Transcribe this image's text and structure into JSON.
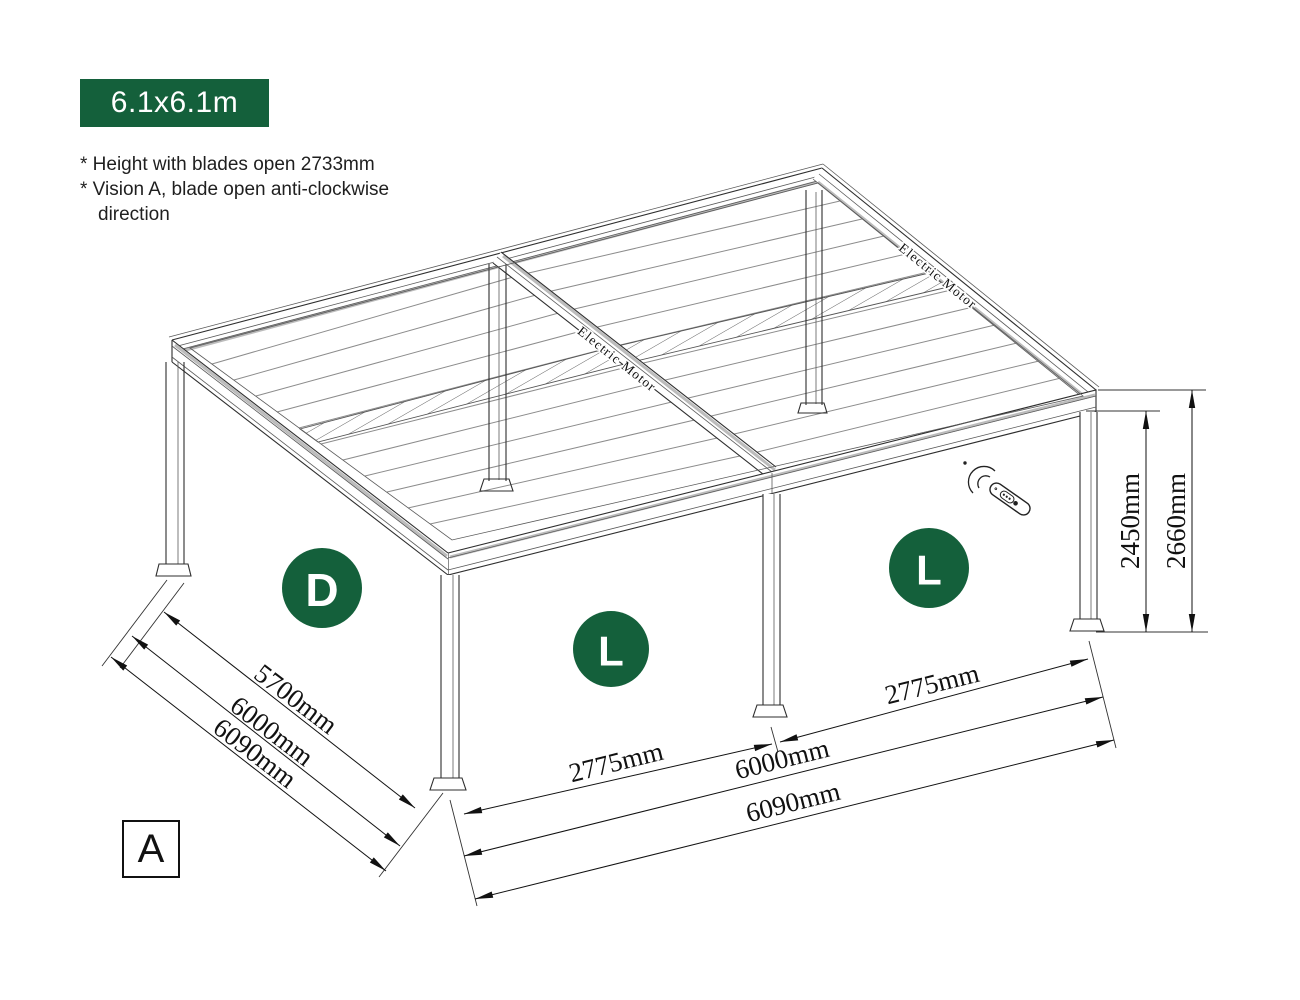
{
  "theme": {
    "accent_green": "#14603B",
    "line_color": "#2e2e2e",
    "background": "#ffffff"
  },
  "header": {
    "size_badge": {
      "label": "6.1x6.1m"
    },
    "notes": [
      "* Height with blades open 2733mm",
      "* Vision A, blade open anti-clockwise",
      "direction"
    ]
  },
  "diagram": {
    "view_label": "A",
    "panel_badges": [
      {
        "label": "D"
      },
      {
        "label": "L"
      },
      {
        "label": "L"
      }
    ],
    "motor_label_left": "Electric Motor",
    "motor_label_right": "Electric Motor",
    "icons": [
      "remote-control-icon"
    ]
  },
  "dimensions": {
    "depth_left": [
      "5700mm",
      "6000mm",
      "6090mm"
    ],
    "front_left_bay": "2775mm",
    "front_right_bay": "2775mm",
    "front_inner": "6000mm",
    "front_overall": "6090mm",
    "post_height": "2450mm",
    "overall_height": "2660mm"
  }
}
